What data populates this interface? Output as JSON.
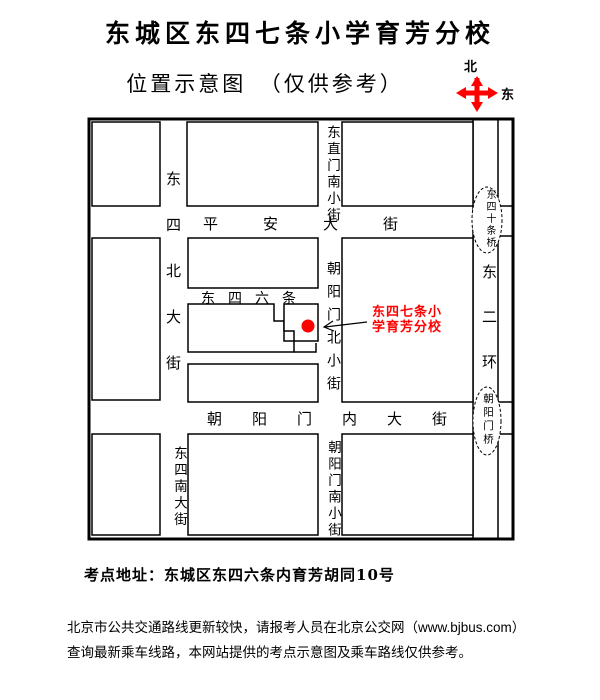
{
  "header": {
    "title": "东城区东四七条小学育芳分校",
    "subtitle": "位置示意图　（仅供参考）"
  },
  "compass": {
    "north_label": "北",
    "east_label": "东",
    "cross_color": "#FF0000"
  },
  "map": {
    "streets": {
      "pingan_dajie": "平安大街",
      "chaoyangmennei_dajie": "朝阳门内大街",
      "dongsi_liutiao": "东四六条",
      "dongsi_bei_dajie": "东四北大街",
      "dongsi_nan_dajie": "东四南大街",
      "dongzhimen_nan_xiaojie": "东直门南小街",
      "chaoyangmen_bei_xiaojie": "朝阳门北小街",
      "chaoyangmen_nan_xiaojie": "朝阳门南小街",
      "dong_er_huan": "东二环"
    },
    "bridges": {
      "dongsishitiao_qiao": "东四十条桥",
      "chaoyangmen_qiao": "朝阳门桥"
    },
    "school": {
      "label": "东四七条小学育芳分校",
      "label_color": "#FF0000",
      "marker_color": "#FF0000"
    }
  },
  "footer": {
    "address": "考点地址：东城区东四六条内育芳胡同10号",
    "note_lines": [
      "北京市公共交通路线更新较快，请报考人员在北京公交网（www.bjbus.com）",
      "查询最新乘车线路，本网站提供的考点示意图及乘车路线仅供参考。"
    ]
  }
}
